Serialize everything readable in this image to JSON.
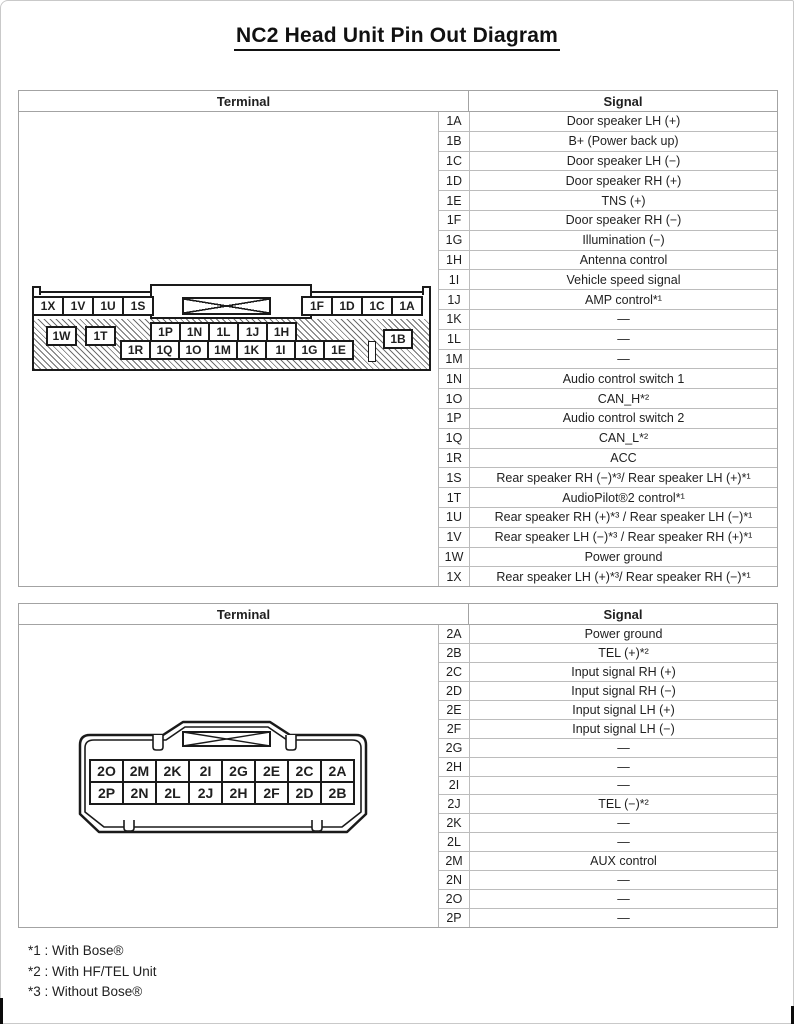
{
  "page": {
    "title": "NC2 Head Unit Pin Out Diagram"
  },
  "colors": {
    "ink": "#1a1a1a",
    "table_border": "#a3a3a3",
    "hatch": "#6e6e6e"
  },
  "table1": {
    "terminal_header": "Terminal",
    "signal_header": "Signal",
    "rows": [
      {
        "pin": "1A",
        "signal": "Door speaker LH (+)"
      },
      {
        "pin": "1B",
        "signal": "B+ (Power back up)"
      },
      {
        "pin": "1C",
        "signal": "Door speaker LH (−)"
      },
      {
        "pin": "1D",
        "signal": "Door speaker RH (+)"
      },
      {
        "pin": "1E",
        "signal": "TNS (+)"
      },
      {
        "pin": "1F",
        "signal": "Door speaker RH (−)"
      },
      {
        "pin": "1G",
        "signal": "Illumination (−)"
      },
      {
        "pin": "1H",
        "signal": "Antenna control"
      },
      {
        "pin": "1I",
        "signal": "Vehicle speed signal"
      },
      {
        "pin": "1J",
        "signal": "AMP control*¹"
      },
      {
        "pin": "1K",
        "signal": "—"
      },
      {
        "pin": "1L",
        "signal": "—"
      },
      {
        "pin": "1M",
        "signal": "—"
      },
      {
        "pin": "1N",
        "signal": "Audio control switch 1"
      },
      {
        "pin": "1O",
        "signal": "CAN_H*²"
      },
      {
        "pin": "1P",
        "signal": "Audio control switch 2"
      },
      {
        "pin": "1Q",
        "signal": "CAN_L*²"
      },
      {
        "pin": "1R",
        "signal": "ACC"
      },
      {
        "pin": "1S",
        "signal": "Rear speaker RH (−)*³/ Rear speaker LH (+)*¹"
      },
      {
        "pin": "1T",
        "signal": "AudioPilot®2 control*¹"
      },
      {
        "pin": "1U",
        "signal": "Rear speaker RH (+)*³ / Rear speaker LH (−)*¹"
      },
      {
        "pin": "1V",
        "signal": "Rear speaker LH (−)*³ / Rear speaker RH (+)*¹"
      },
      {
        "pin": "1W",
        "signal": "Power ground"
      },
      {
        "pin": "1X",
        "signal": "Rear speaker LH (+)*³/ Rear speaker RH (−)*¹"
      }
    ]
  },
  "connector1": {
    "top_row_left": [
      "1X",
      "1V",
      "1U",
      "1S"
    ],
    "top_row_right": [
      "1F",
      "1D",
      "1C",
      "1A"
    ],
    "left_pins": [
      "1W",
      "1T"
    ],
    "mid_upper": [
      "1P",
      "1N",
      "1L",
      "1J",
      "1H"
    ],
    "mid_lower": [
      "1R",
      "1Q",
      "1O",
      "1M",
      "1K",
      "1I",
      "1G",
      "1E"
    ],
    "right_pin": "1B"
  },
  "table2": {
    "terminal_header": "Terminal",
    "signal_header": "Signal",
    "rows": [
      {
        "pin": "2A",
        "signal": "Power ground"
      },
      {
        "pin": "2B",
        "signal": "TEL (+)*²"
      },
      {
        "pin": "2C",
        "signal": "Input signal RH (+)"
      },
      {
        "pin": "2D",
        "signal": "Input signal RH (−)"
      },
      {
        "pin": "2E",
        "signal": "Input signal LH (+)"
      },
      {
        "pin": "2F",
        "signal": "Input signal LH (−)"
      },
      {
        "pin": "2G",
        "signal": "—"
      },
      {
        "pin": "2H",
        "signal": "—"
      },
      {
        "pin": "2I",
        "signal": "—"
      },
      {
        "pin": "2J",
        "signal": "TEL (−)*²"
      },
      {
        "pin": "2K",
        "signal": "—"
      },
      {
        "pin": "2L",
        "signal": "—"
      },
      {
        "pin": "2M",
        "signal": "AUX control"
      },
      {
        "pin": "2N",
        "signal": "—"
      },
      {
        "pin": "2O",
        "signal": "—"
      },
      {
        "pin": "2P",
        "signal": "—"
      }
    ]
  },
  "connector2": {
    "row_top": [
      "2O",
      "2M",
      "2K",
      "2I",
      "2G",
      "2E",
      "2C",
      "2A"
    ],
    "row_bottom": [
      "2P",
      "2N",
      "2L",
      "2J",
      "2H",
      "2F",
      "2D",
      "2B"
    ]
  },
  "footnotes": [
    "*1 : With Bose®",
    "*2 : With HF/TEL Unit",
    "*3 : Without Bose®"
  ]
}
